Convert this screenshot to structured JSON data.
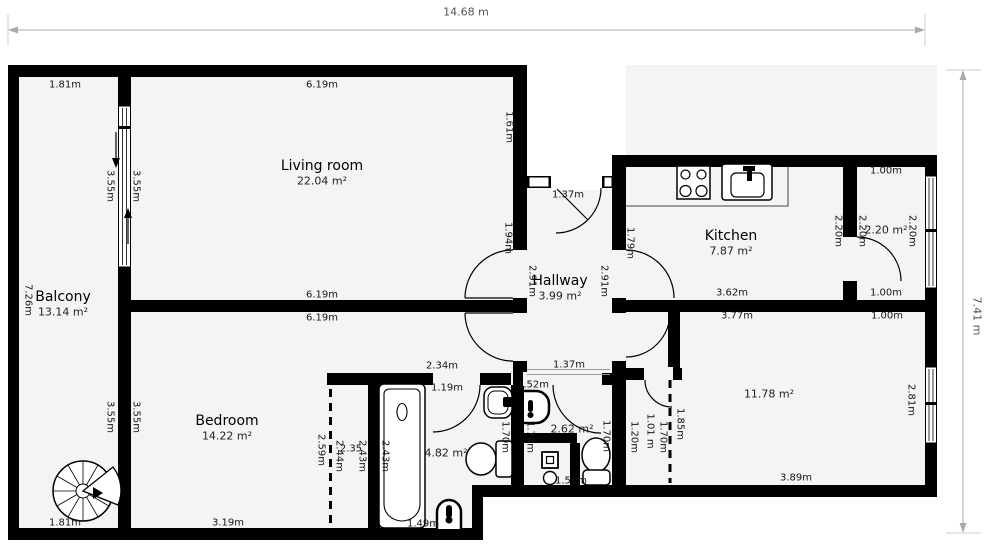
{
  "dimension_lines": {
    "top": {
      "label": "14.68 m"
    },
    "right": {
      "label": "7.41 m"
    }
  },
  "rooms": [
    {
      "name": "Balcony",
      "area": "13.14 m²",
      "x": 63,
      "y": 297
    },
    {
      "name": "Living room",
      "area": "22.04 m²",
      "x": 322,
      "y": 166
    },
    {
      "name": "Hallway",
      "area": "3.99 m²",
      "x": 560,
      "y": 281
    },
    {
      "name": "Kitchen",
      "area": "7.87 m²",
      "x": 731,
      "y": 236
    },
    {
      "name": "Bedroom",
      "area": "14.22 m²",
      "x": 227,
      "y": 421
    }
  ],
  "area_labels": [
    {
      "t": "2.20 m²",
      "x": 886,
      "y": 230
    },
    {
      "t": "11.78 m²",
      "x": 769,
      "y": 394
    },
    {
      "t": "4.82 m²",
      "x": 446,
      "y": 453
    },
    {
      "t": "2.62 m²",
      "x": 572,
      "y": 429
    }
  ],
  "measurements": [
    {
      "t": "1.81m",
      "x": 65,
      "y": 85
    },
    {
      "t": "6.19m",
      "x": 322,
      "y": 85
    },
    {
      "t": "1.61m",
      "x": 509,
      "y": 127,
      "r": 90
    },
    {
      "t": "3.55m",
      "x": 110,
      "y": 186,
      "r": 90
    },
    {
      "t": "3.55m",
      "x": 136,
      "y": 186,
      "r": 90
    },
    {
      "t": "7.26m",
      "x": 28,
      "y": 300,
      "r": 90
    },
    {
      "t": "1.37m",
      "x": 568,
      "y": 195
    },
    {
      "t": "1.94m",
      "x": 508,
      "y": 238,
      "r": 90
    },
    {
      "t": "1.79m",
      "x": 630,
      "y": 243,
      "r": 90
    },
    {
      "t": "2.91m",
      "x": 532,
      "y": 281,
      "r": 90
    },
    {
      "t": "2.91m",
      "x": 604,
      "y": 281,
      "r": 90
    },
    {
      "t": "1.00m",
      "x": 886,
      "y": 171
    },
    {
      "t": "2.20m",
      "x": 838,
      "y": 231,
      "r": 90
    },
    {
      "t": "2.20m",
      "x": 862,
      "y": 231,
      "r": 90
    },
    {
      "t": "2.20m",
      "x": 912,
      "y": 231,
      "r": 90
    },
    {
      "t": "3.62m",
      "x": 732,
      "y": 293
    },
    {
      "t": "1.00m",
      "x": 886,
      "y": 293
    },
    {
      "t": "3.77m",
      "x": 737,
      "y": 316
    },
    {
      "t": "1.00m",
      "x": 887,
      "y": 316
    },
    {
      "t": "6.19m",
      "x": 322,
      "y": 295
    },
    {
      "t": "6.19m",
      "x": 322,
      "y": 318
    },
    {
      "t": "3.55m",
      "x": 110,
      "y": 417,
      "r": 90
    },
    {
      "t": "3.55m",
      "x": 136,
      "y": 417,
      "r": 90
    },
    {
      "t": "2.59m",
      "x": 321,
      "y": 450,
      "r": 90
    },
    {
      "t": "2.44m",
      "x": 339,
      "y": 456,
      "r": 90
    },
    {
      "t": "2.35",
      "x": 351,
      "y": 449
    },
    {
      "t": "2.43m",
      "x": 362,
      "y": 456,
      "r": 90
    },
    {
      "t": "2.43m",
      "x": 385,
      "y": 456,
      "r": 90
    },
    {
      "t": "3.19m",
      "x": 228,
      "y": 523
    },
    {
      "t": "1.81m",
      "x": 65,
      "y": 523
    },
    {
      "t": "2.34m",
      "x": 442,
      "y": 366
    },
    {
      "t": "1.19m",
      "x": 447,
      "y": 388
    },
    {
      "t": "1.37m",
      "x": 569,
      "y": 365
    },
    {
      "t": "1.52m",
      "x": 533,
      "y": 385
    },
    {
      "t": "1.49m",
      "x": 423,
      "y": 524
    },
    {
      "t": "1.70m",
      "x": 505,
      "y": 437,
      "r": 90
    },
    {
      "t": "1.70m",
      "x": 530,
      "y": 437,
      "r": 90
    },
    {
      "t": "1.70m",
      "x": 606,
      "y": 436,
      "r": 90
    },
    {
      "t": "1.20m",
      "x": 634,
      "y": 437,
      "r": 90
    },
    {
      "t": "1.01 m",
      "x": 650,
      "y": 431,
      "r": 90
    },
    {
      "t": "1.70m",
      "x": 663,
      "y": 437,
      "r": 90
    },
    {
      "t": "1.85m",
      "x": 680,
      "y": 424,
      "r": 90
    },
    {
      "t": "2.81m",
      "x": 911,
      "y": 400,
      "r": 90
    },
    {
      "t": "3.89m",
      "x": 796,
      "y": 478
    },
    {
      "t": "1.51m",
      "x": 571,
      "y": 481
    }
  ]
}
